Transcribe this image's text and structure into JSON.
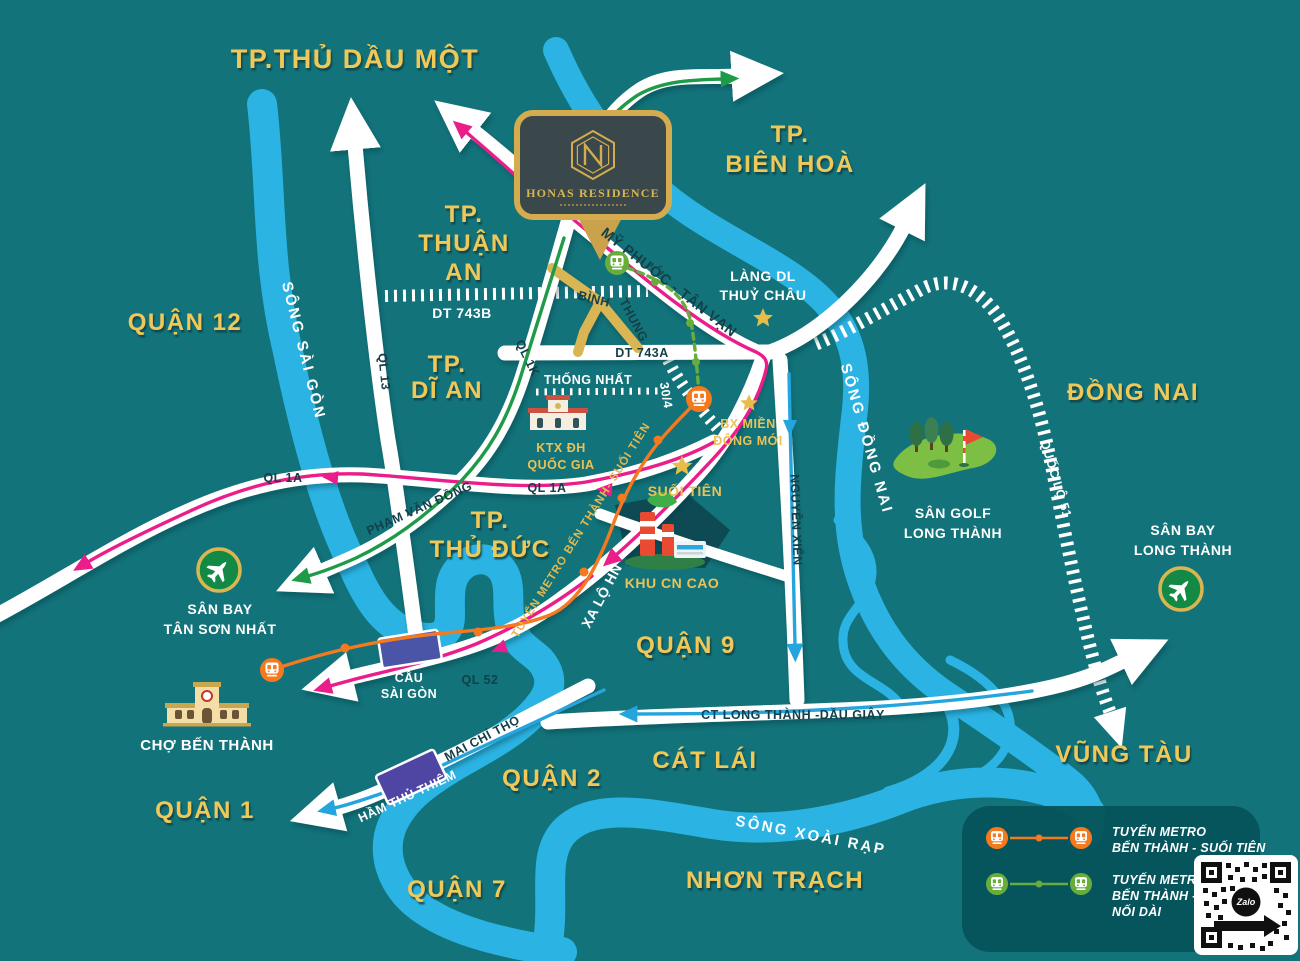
{
  "project": {
    "name": "HONAS RESIDENCE"
  },
  "regions": {
    "thu_dau_mot": "TP.THỦ DẦU MỘT",
    "bien_hoa_1": "TP.",
    "bien_hoa_2": "BIÊN HOÀ",
    "thuan_an_1": "TP.",
    "thuan_an_2": "THUẬN",
    "thuan_an_3": "AN",
    "quan_12": "QUẬN 12",
    "di_an_1": "TP.",
    "di_an_2": "DĨ AN",
    "dong_nai": "ĐỒNG NAI",
    "thu_duc_1": "TP.",
    "thu_duc_2": "THỦ ĐỨC",
    "quan_9": "QUẬN 9",
    "quan_2": "QUẬN 2",
    "cat_lai": "CÁT LÁI",
    "vung_tau": "VŨNG TÀU",
    "quan_1": "QUẬN 1",
    "quan_7": "QUẬN 7",
    "nhon_trach": "NHƠN TRẠCH"
  },
  "rivers": {
    "sai_gon": "SÔNG SÀI GÒN",
    "dong_nai": "SÔNG ĐỒNG NAI",
    "xoai_rap": "SÔNG XOÀI RẠP"
  },
  "roads": {
    "ql13": "QL 13",
    "dt743b": "DT 743B",
    "dt743a": "DT 743A",
    "ql1k": "QL 1K",
    "my_phuoc_tan_van": "MỸ PHƯỚC - TÂN VẠN",
    "binh_1": "BÌNH",
    "binh_2": "THUNG",
    "thong_nhat": "THỐNG NHẤT",
    "duong_304": "30/4",
    "ql1a": "QL 1A",
    "ql1a_b": "QL 1A",
    "pham_van_dong": "PHẠM VĂN ĐỒNG",
    "xa_lo_hn": "XA LỘ HN",
    "nguyen_xien": "NGUYỄN XIỂN",
    "quoc_lo_51": "QUỐC LỘ 51",
    "ql52": "QL 52",
    "cau_sai_gon_1": "CẦU",
    "cau_sai_gon_2": "SÀI GÒN",
    "mai_chi_tho": "MAI CHÍ THỌ",
    "ham_thu_thiem": "HẦM THỦ THIÊM",
    "ct_long_thanh": "CT LONG THÀNH -DẦU GIÂY"
  },
  "pois": {
    "lang_dl_1": "LÀNG DL",
    "lang_dl_2": "THUỶ CHÂU",
    "ktx_1": "KTX ĐH",
    "ktx_2": "QUỐC GIA",
    "bx_1": "BX MIỀN",
    "bx_2": "ĐÔNG MỚI",
    "suoi_tien": "SUỐI TIÊN",
    "khu_cn_cao": "KHU CN CAO",
    "san_golf_1": "SÂN GOLF",
    "san_golf_2": "LONG THÀNH",
    "san_bay_lt_1": "SÂN BAY",
    "san_bay_lt_2": "LONG THÀNH",
    "san_bay_tsn_1": "SÂN BAY",
    "san_bay_tsn_2": "TÂN SƠN NHẤT",
    "cho_ben_thanh": "CHỢ BẾN THÀNH",
    "metro_line": "TUYẾN METRO BẾN THÀNH- SUỐI TIÊN"
  },
  "legend": {
    "metro1_1": "TUYẾN METRO",
    "metro1_2": "BẾN THÀNH - SUỐI TIÊN",
    "metro2_1": "TUYẾN METRO",
    "metro2_2": "BẾN THÀNH - SUỐI TIÊN",
    "metro2_3": "NỐI DÀI"
  },
  "qr": {
    "brand": "Zalo"
  },
  "colors": {
    "background": "#12737a",
    "river": "#2bb3e3",
    "road": "#ffffff",
    "label_gold": "#eec859",
    "route_pink": "#ea1d8a",
    "route_green": "#1e9b48",
    "route_blue": "#25a5dd",
    "metro_orange": "#f5791f",
    "metro_green": "#66ad3c",
    "gold_road": "#d9b652",
    "card_border": "#d5ab4f"
  }
}
